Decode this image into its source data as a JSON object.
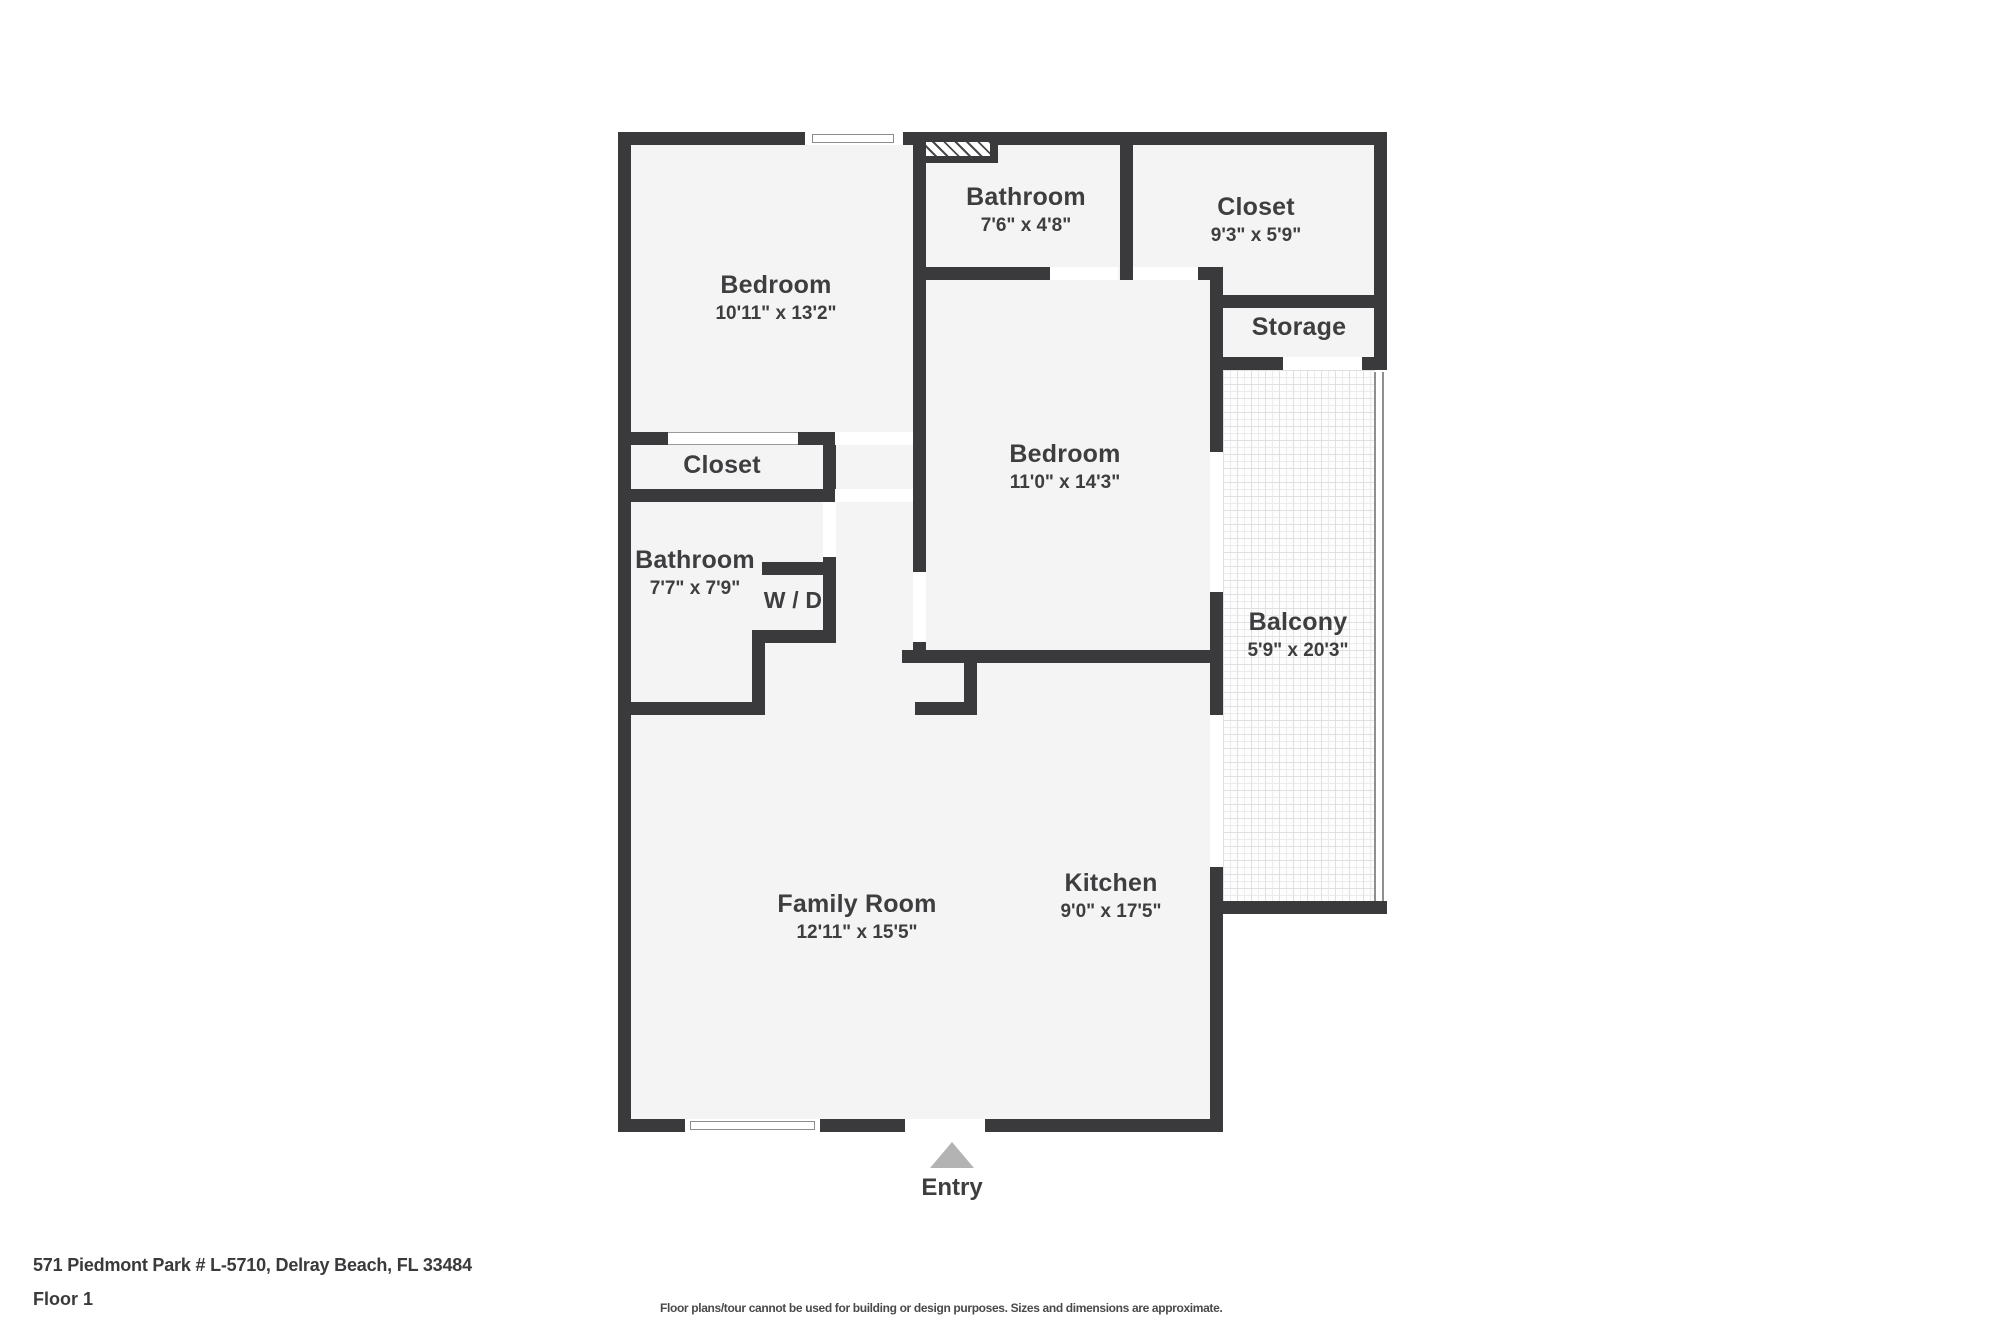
{
  "plan": {
    "rooms": {
      "bedroom1": {
        "name": "Bedroom",
        "dims": "10'11\" x 13'2\""
      },
      "bathroom1": {
        "name": "Bathroom",
        "dims": "7'6\" x 4'8\""
      },
      "closet1": {
        "name": "Closet",
        "dims": "9'3\" x 5'9\""
      },
      "storage": {
        "name": "Storage"
      },
      "bedroom2": {
        "name": "Bedroom",
        "dims": "11'0\" x 14'3\""
      },
      "closet2": {
        "name": "Closet"
      },
      "bathroom2": {
        "name": "Bathroom",
        "dims": "7'7\" x 7'9\""
      },
      "wd": {
        "name": "W / D"
      },
      "balcony": {
        "name": "Balcony",
        "dims": "5'9\" x 20'3\""
      },
      "family_room": {
        "name": "Family Room",
        "dims": "12'11\" x 15'5\""
      },
      "kitchen": {
        "name": "Kitchen",
        "dims": "9'0\" x 17'5\""
      }
    },
    "entry_label": "Entry"
  },
  "footer": {
    "address": "571 Piedmont Park # L-5710, Delray Beach, FL 33484",
    "floor": "Floor 1",
    "disclaimer": "Floor plans/tour cannot be used for building or design purposes. Sizes and dimensions are approximate."
  },
  "colors": {
    "wall": "#3a3a3c",
    "interior": "#f5f4f4",
    "text": "#3e3e40",
    "entry_arrow": "#b3b3b3"
  }
}
